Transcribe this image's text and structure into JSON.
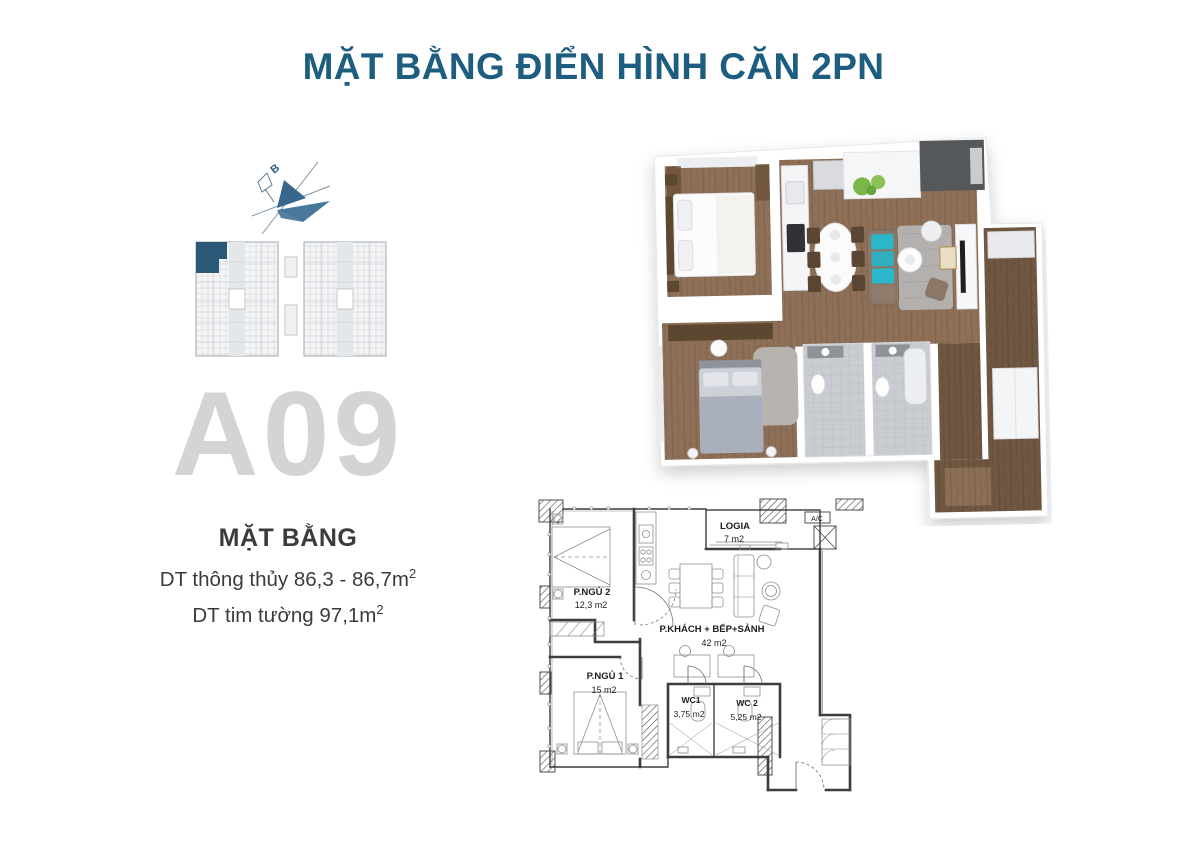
{
  "page": {
    "title": "MẶT BẰNG ĐIỂN HÌNH CĂN 2PN"
  },
  "compass": {
    "north_label": "B"
  },
  "keyplan": {
    "highlighted_unit": "A09"
  },
  "unit": {
    "code": "A09",
    "heading": "MẶT BẰNG",
    "net_area_text": "DT thông thủy 86,3 - 86,7m",
    "net_area_sup": "2",
    "gross_area_text": "DT tim tường 97,1m",
    "gross_area_sup": "2"
  },
  "floorplan2d": {
    "ac_label": "A/C",
    "rooms": {
      "logia": {
        "name": "LOGIA",
        "area": "7 m2"
      },
      "bedroom2": {
        "name": "P.NGỦ 2",
        "area": "12,3 m2"
      },
      "living": {
        "name": "P.KHÁCH + BẾP+SẢNH",
        "area": "42 m2"
      },
      "bedroom1": {
        "name": "P.NGỦ 1",
        "area": "15 m2"
      },
      "wc1": {
        "name": "WC1",
        "area": "3,75 m2"
      },
      "wc2": {
        "name": "WC 2",
        "area": "5,25 m2"
      }
    }
  },
  "colors": {
    "accent": "#1d5d7f",
    "unit_highlight": "#2a5a78",
    "watermark": "#d2d4d6"
  }
}
